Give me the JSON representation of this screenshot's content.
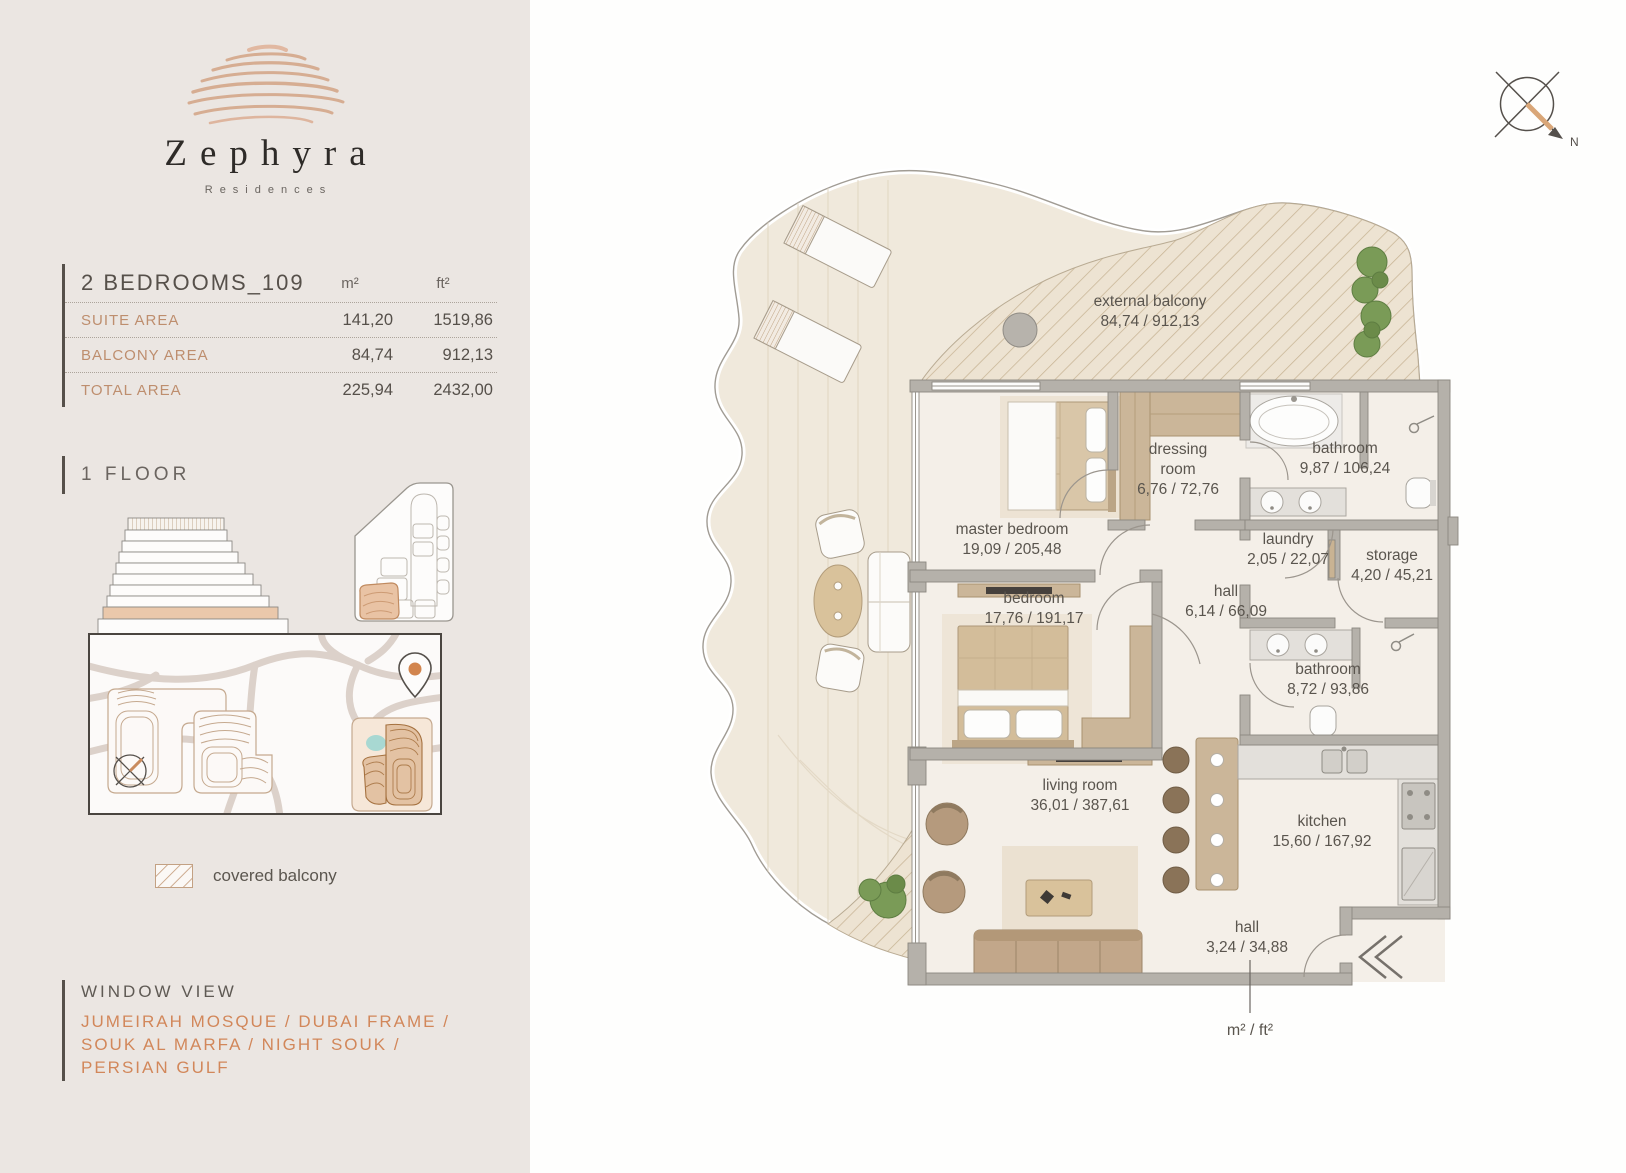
{
  "brand": {
    "name": "Zephyra",
    "subtitle": "Residences"
  },
  "unit": {
    "title": "2 BEDROOMS_109",
    "col_m2": "m²",
    "col_ft2": "ft²",
    "rows": [
      {
        "label": "SUITE AREA",
        "m2": "141,20",
        "ft2": "1519,86"
      },
      {
        "label": "BALCONY AREA",
        "m2": "84,74",
        "ft2": "912,13"
      },
      {
        "label": "TOTAL AREA",
        "m2": "225,94",
        "ft2": "2432,00"
      }
    ]
  },
  "floor": {
    "label": "1 FLOOR"
  },
  "legend": {
    "covered_balcony": "covered balcony"
  },
  "window_view": {
    "title": "WINDOW VIEW",
    "line1": "JUMEIRAH MOSQUE / DUBAI FRAME /",
    "line2": "SOUK AL MARFA / NIGHT SOUK /",
    "line3": "PERSIAN GULF"
  },
  "plan": {
    "north": "N",
    "units_note": "m² / ft²",
    "rooms": [
      {
        "name": "external balcony",
        "area": "84,74 / 912,13"
      },
      {
        "name": "master bedroom",
        "area": "19,09 / 205,48"
      },
      {
        "name": "dressing room",
        "area": "6,76 / 72,76"
      },
      {
        "name": "bathroom",
        "area": "9,87 / 106,24"
      },
      {
        "name": "laundry",
        "area": "2,05 / 22,07"
      },
      {
        "name": "storage",
        "area": "4,20 / 45,21"
      },
      {
        "name": "hall",
        "area": "6,14 / 66,09"
      },
      {
        "name": "bedroom",
        "area": "17,76 / 191,17"
      },
      {
        "name": "bathroom",
        "area": "8,72 / 93,86"
      },
      {
        "name": "living room",
        "area": "36,01 / 387,61"
      },
      {
        "name": "kitchen",
        "area": "15,60 / 167,92"
      },
      {
        "name": "hall",
        "area": "3,24 / 34,88"
      }
    ]
  },
  "colors": {
    "accent_tan": "#D4A78A",
    "accent_orange": "#D2875A",
    "wall_gray": "#B5B1AA",
    "floor_beige": "#F0E9DC",
    "hatch_line": "#C8B494",
    "text_dark": "#56504A",
    "map_teal": "#A8D8D2",
    "plant_green": "#7A9B57"
  }
}
